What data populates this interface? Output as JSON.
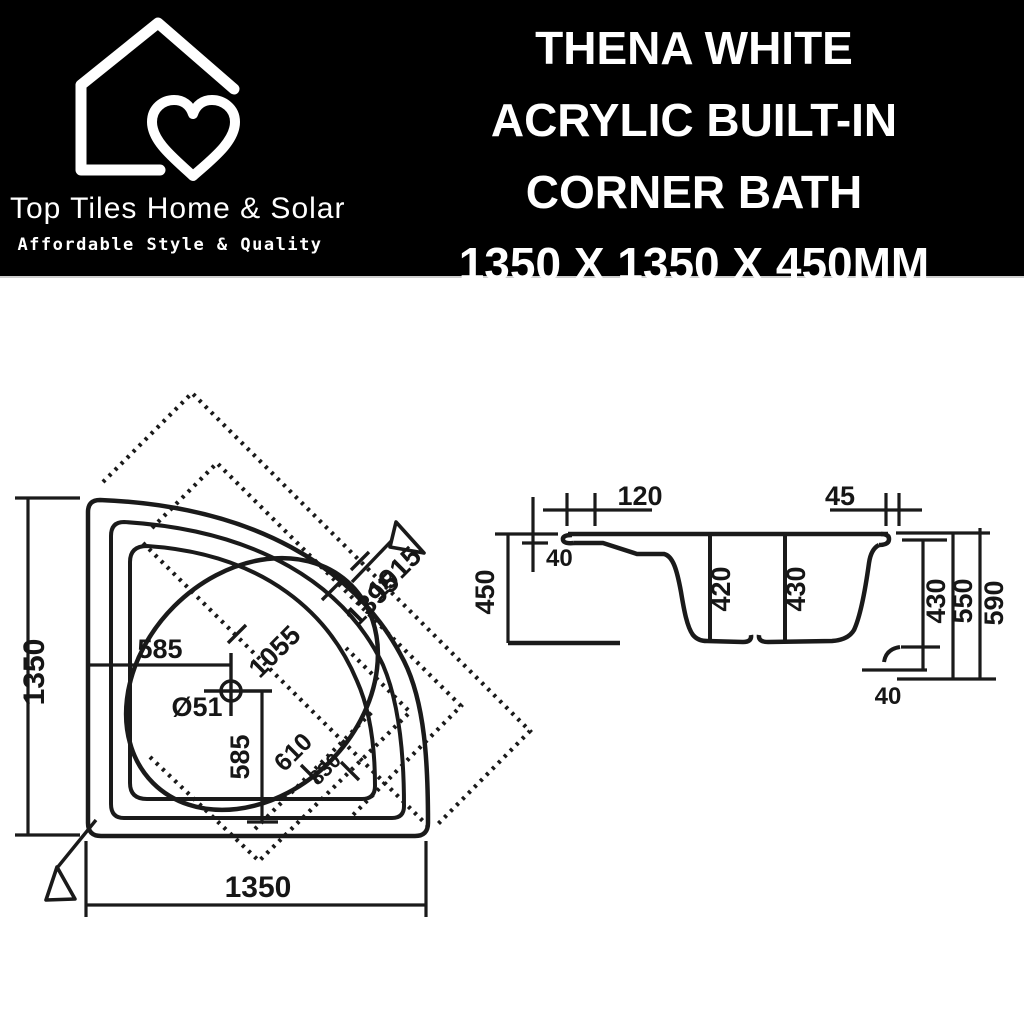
{
  "header": {
    "brand": {
      "name": "Top Tiles Home & Solar",
      "tagline": "Affordable Style & Quality"
    },
    "title_lines": [
      "THENA WHITE",
      "ACRYLIC BUILT-IN",
      "CORNER BATH",
      "1350 X 1350 X 450MM"
    ]
  },
  "plan_view": {
    "width": "1350",
    "height": "1350",
    "drain_from_left": "585",
    "drain_from_bottom": "585",
    "drain_diameter": "Ø51",
    "diag_overall": "1915",
    "diag_rim": "1395",
    "diag_mid": "1055",
    "diag_basin_long": "830",
    "diag_basin_short": "610"
  },
  "section_view": {
    "height": "450",
    "rim_edge": "40",
    "front_ledge": "120",
    "back_ledge": "45",
    "depth_front": "420",
    "depth_back": "430",
    "right_inner": "430",
    "right_mid": "550",
    "right_overall": "590",
    "base": "40"
  },
  "colors": {
    "header_bg": "#000000",
    "text_on_header": "#ffffff",
    "line": "#1a1a1a",
    "background": "#ffffff"
  }
}
